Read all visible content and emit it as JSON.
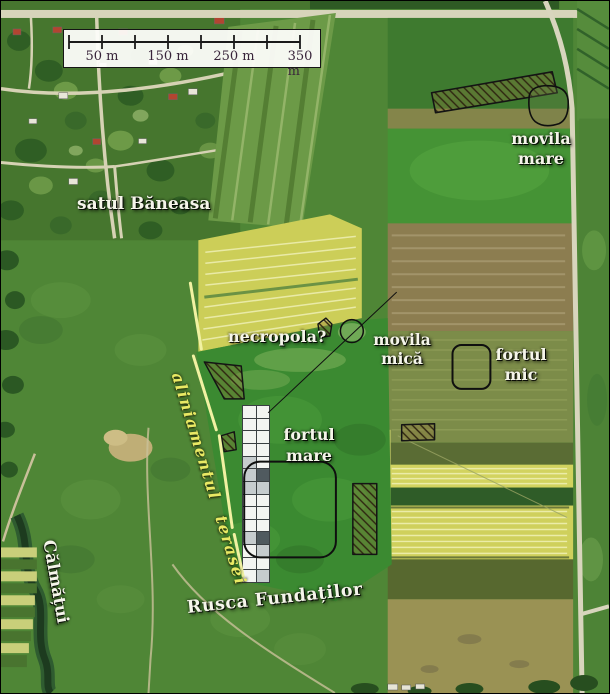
{
  "scalebar": {
    "tick_labels": [
      "50 m",
      "150 m",
      "250 m",
      "350 m"
    ]
  },
  "labels": {
    "village": "satul Băneasa",
    "movila_mare": {
      "line1": "movila",
      "line2": "mare"
    },
    "necropola": "necropola?",
    "movila_mica": {
      "line1": "movila",
      "line2": "mică"
    },
    "fortul_mic": {
      "line1": "fortul",
      "line2": "mic"
    },
    "fortul_mare": {
      "line1": "fortul",
      "line2": "mare"
    },
    "aliniament": "aliniamentul terasei",
    "river": "Călmățui",
    "site": "Rusca Fundaților"
  },
  "grid": {
    "rows": 14,
    "cols": 2,
    "cells": [
      [
        "w",
        "w"
      ],
      [
        "w",
        "w"
      ],
      [
        "w",
        "w"
      ],
      [
        "w",
        "w"
      ],
      [
        "lg",
        "w"
      ],
      [
        "lg",
        "dg"
      ],
      [
        "lg",
        "lg"
      ],
      [
        "w",
        "w"
      ],
      [
        "w",
        "w"
      ],
      [
        "w",
        "w"
      ],
      [
        "lg",
        "dg"
      ],
      [
        "w",
        "lg"
      ],
      [
        "w",
        "w"
      ],
      [
        "w",
        "lg"
      ]
    ],
    "palette": {
      "w": "#f3f4f1",
      "lg": "#c6ccce",
      "dg": "#505a5f"
    }
  },
  "colors": {
    "annotation_yellow": "#f1f1a2",
    "aliniament_text": "#e9e964",
    "label_white": "#f5f5ea",
    "outline_black": "#0f0f0f",
    "hatch_line": "#2e2410",
    "hatch_fill": "rgba(148,118,58,0.32)",
    "scalebar_text": "#38243a"
  }
}
